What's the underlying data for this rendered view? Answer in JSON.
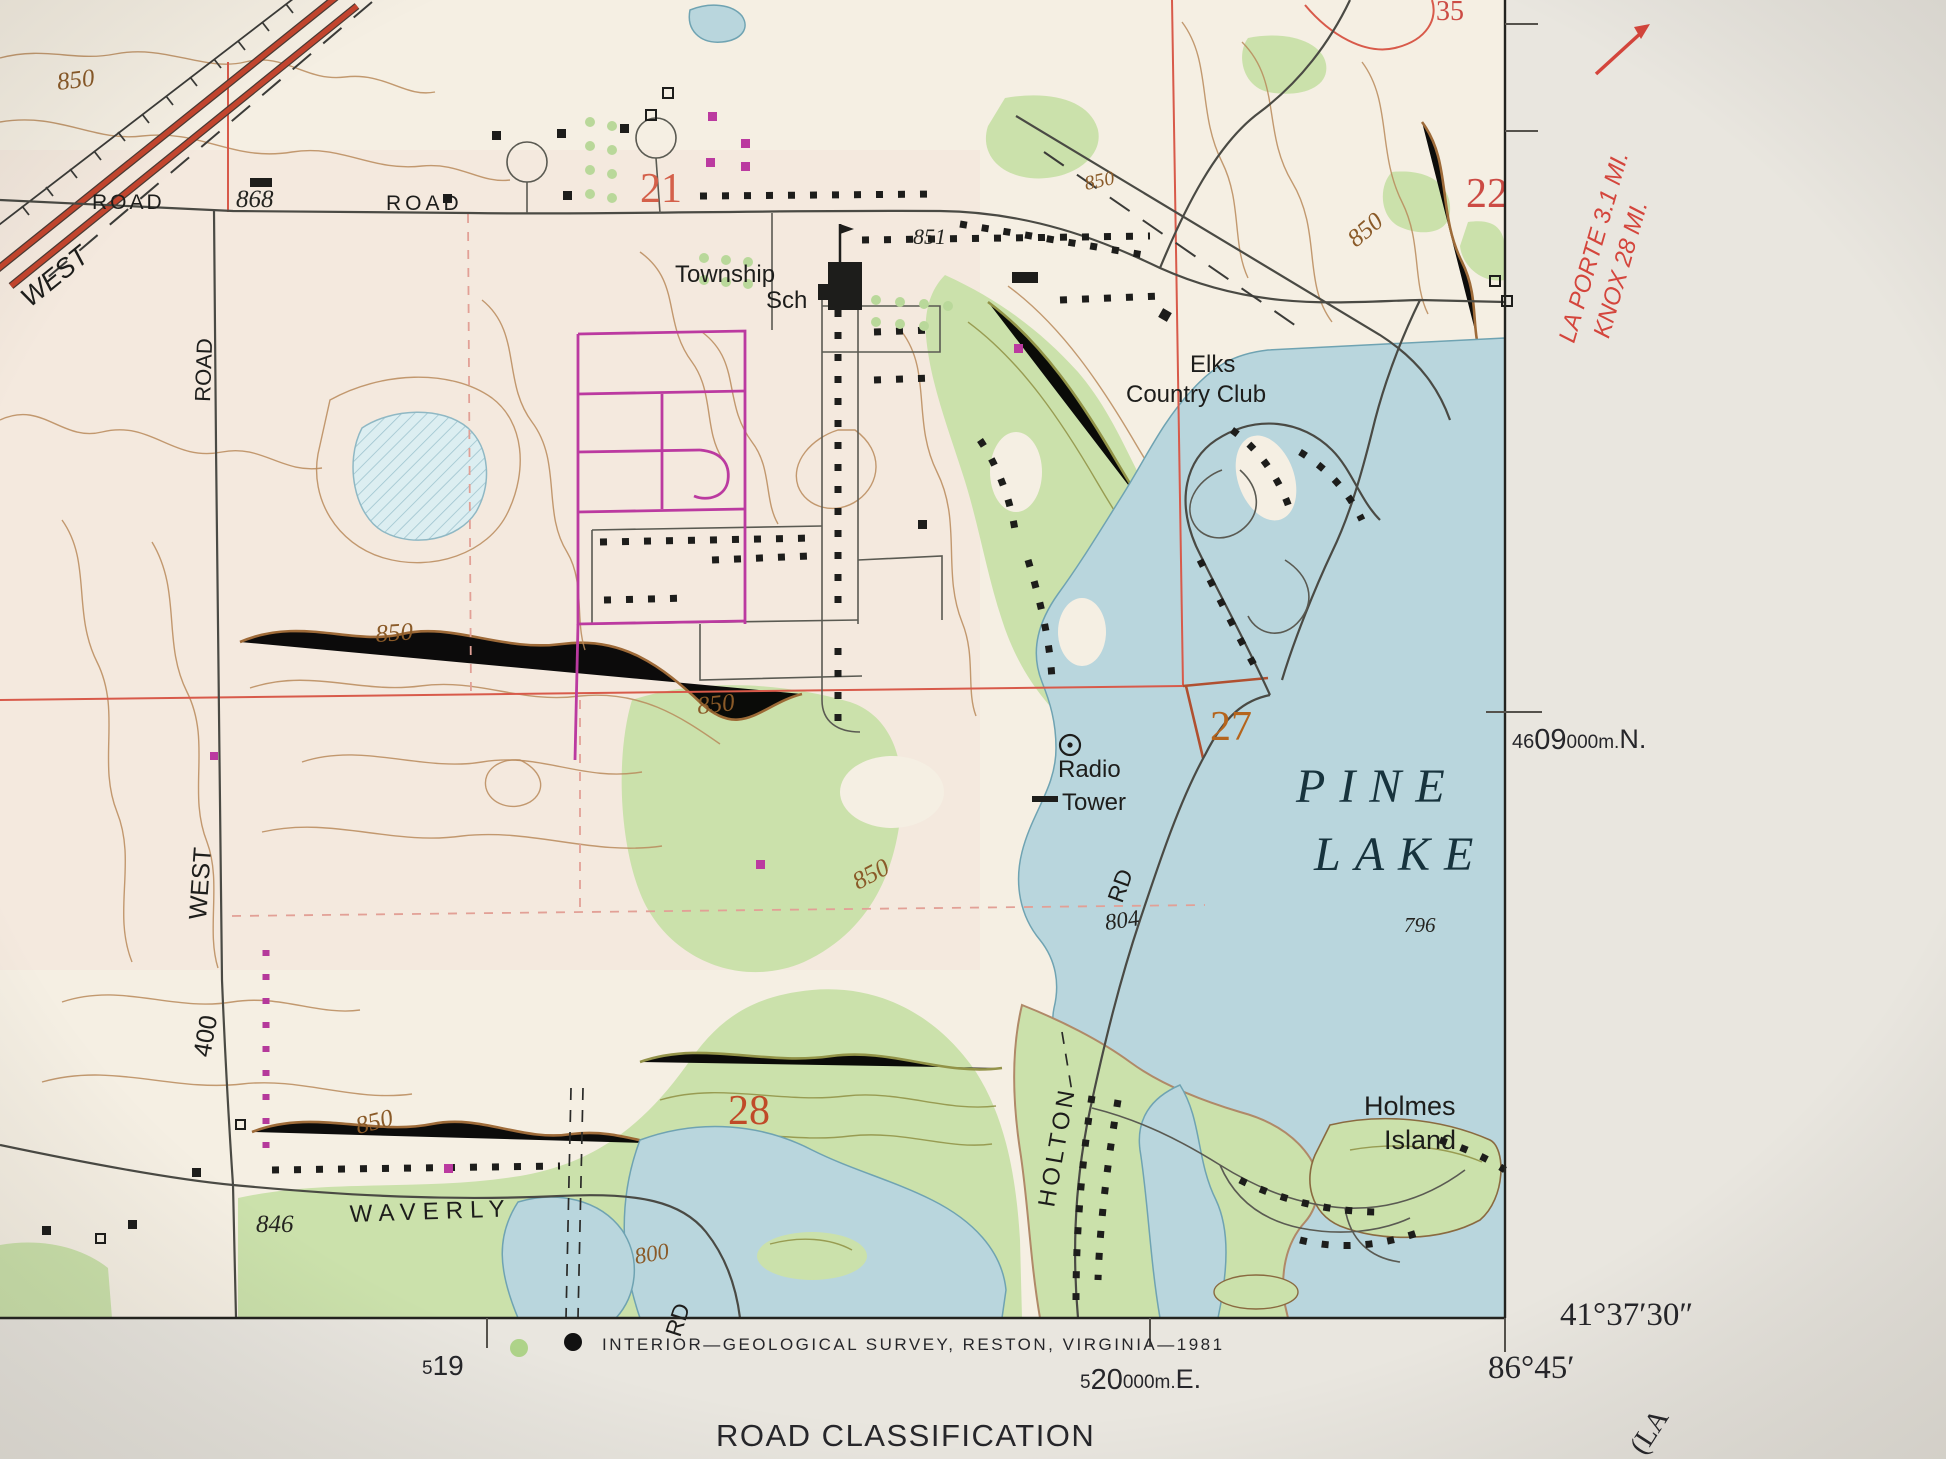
{
  "colors": {
    "paper": "#f5efe3",
    "margin_paper": "#e9e6df",
    "water": "#b9d6dd",
    "vegetation": "#cbe1ab",
    "contour_brown": "#9a6430",
    "grid_red": "#d85a4a",
    "photorevision_magenta": "#bb3aa0",
    "section_orange": "#b5651d"
  },
  "map": {
    "section_numbers": {
      "s21": "21",
      "s22": "22",
      "s27": "27",
      "s28": "28",
      "s35": "35"
    },
    "contour_labels": {
      "a": "850",
      "b": "850",
      "c": "850",
      "d": "850",
      "e": "850",
      "f": "850",
      "g": "850",
      "h": "800"
    },
    "spot_elevations": {
      "e868": "868",
      "e851": "851",
      "e846": "846",
      "e804": "804",
      "e796": "796"
    },
    "places": {
      "township_line1": "Township",
      "township_line2": "Sch",
      "elks_line1": "Elks",
      "elks_line2": "Country Club",
      "radio_line1": "Radio",
      "radio_line2": "Tower",
      "pine": "PINE",
      "lake": "LAKE",
      "holmes_line1": "Holmes",
      "holmes_line2": "Island"
    },
    "roads": {
      "top_partial": "ROAD",
      "top": "ROAD",
      "vertical": "ROAD",
      "west_highway": "WEST",
      "west": "WEST",
      "n400": "400",
      "waverly": "WAVERLY",
      "waverly_rd": "RD",
      "holton": "HOLTON",
      "holton_rd": "RD"
    }
  },
  "margin": {
    "destination_line1": "LA PORTE 3.1 MI.",
    "destination_line2": "KNOX 28 MI.",
    "grid_north": {
      "p1": "46",
      "p2": "09",
      "p3": "000m.",
      "p4": "N."
    },
    "grid_east": {
      "p1": "5",
      "p2": "20",
      "p3": "000m.",
      "p4": "E."
    },
    "grid_519": {
      "p1": "5",
      "p2": "19"
    },
    "corner_lat": "41°37′30″",
    "corner_lon": "86°45′",
    "credit": "INTERIOR—GEOLOGICAL SURVEY, RESTON, VIRGINIA—1981",
    "road_classification": "ROAD CLASSIFICATION",
    "adjoining_quad": "(LA"
  }
}
